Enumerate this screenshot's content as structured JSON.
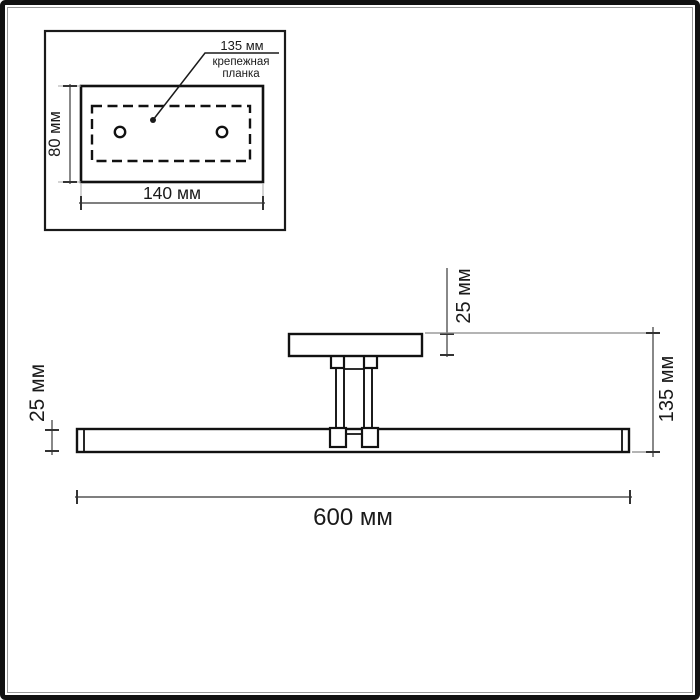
{
  "drawing_title": "wall-picture-light dimension diagram",
  "colors": {
    "background": "#ffffff",
    "object_line": "#111111",
    "dimension_line": "#555555",
    "tick": "#333333",
    "extension_line": "#aaaaaa",
    "text": "#1a1a1a",
    "frame": "#111111",
    "frame_inner_line": "#999999"
  },
  "inset": {
    "dimensions": {
      "hole_spacing": "135 мм",
      "plate_height": "80 мм",
      "plate_width": "140 мм"
    },
    "annotation": "крепежная\nпланка"
  },
  "main_view": {
    "dimensions": {
      "canopy_thickness": "25 мм",
      "bar_thickness": "25 мм",
      "overall_height": "135 мм",
      "overall_length": "600 мм"
    }
  }
}
